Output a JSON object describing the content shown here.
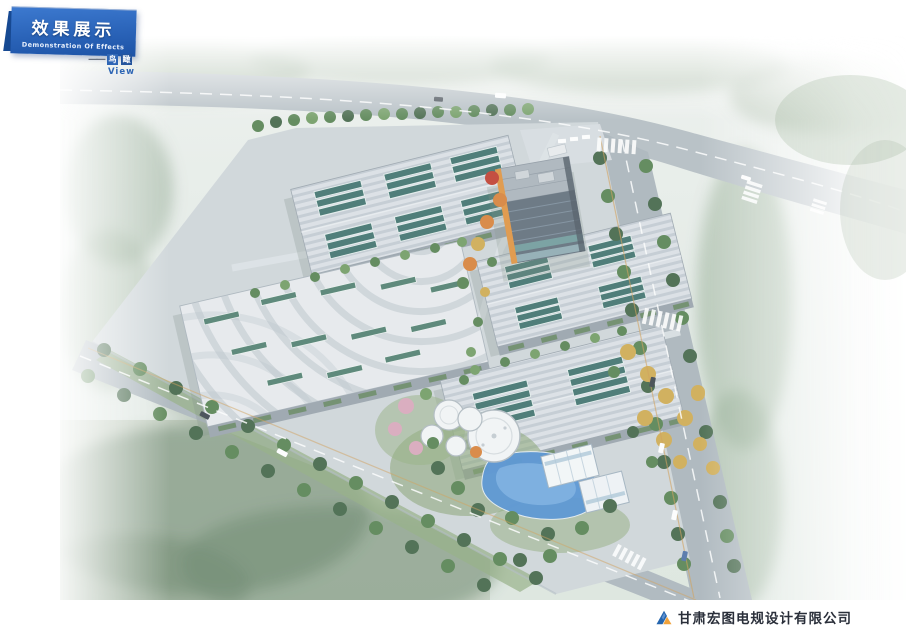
{
  "banner": {
    "title": "效果展示",
    "subtitle": "Demonstration Of Effects",
    "bg_color": "#2a63b8",
    "dark_tab_color": "#174a93"
  },
  "view_label": {
    "dash": "——",
    "tag_chars": [
      "鸟",
      "瞰"
    ],
    "caption": "View",
    "accent_color": "#2f66b5"
  },
  "footer": {
    "company_name": "甘肃宏图电规设计有限公司",
    "logo_colors": {
      "blue": "#2565ae",
      "orange": "#f0a23c"
    }
  },
  "scene": {
    "palette": {
      "haze": "#e7ece9",
      "road_grey": "#aab4bb",
      "roof_stripe": "#c2cad2",
      "solar_panel_teal": "#3c6f6a",
      "skylight_green": "#4d7d6d",
      "tree_dark": "#3f6244",
      "tree_mid": "#54804e",
      "tree_yellow": "#cfa94d",
      "tree_orange": "#d87f35",
      "tree_red": "#c0392b",
      "tree_pink": "#d9a6ba",
      "pond_blue": "#4d8ed2",
      "tank_white": "#f3f5f6",
      "office_accent_orange": "#e0913c",
      "lawn_green": "#8aa873"
    }
  }
}
